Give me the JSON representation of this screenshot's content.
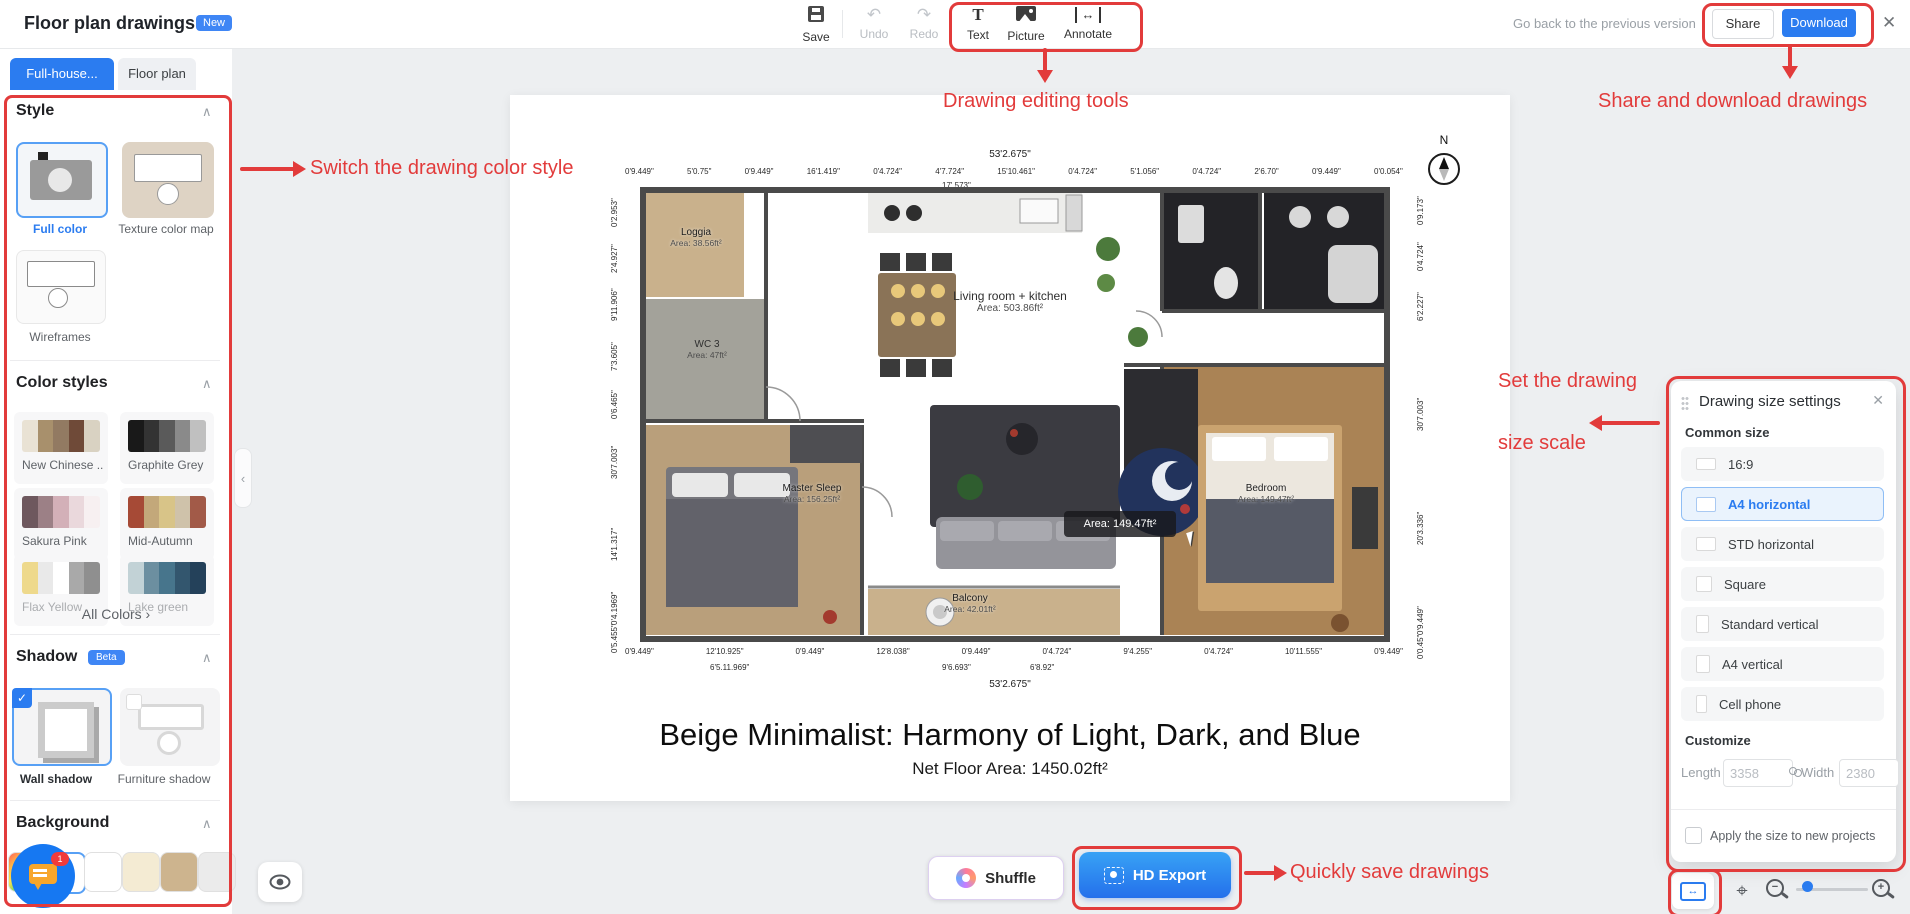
{
  "header": {
    "title": "Floor plan drawings",
    "badge": "New",
    "save": "Save",
    "undo": "Undo",
    "redo": "Redo",
    "text_tool": "Text",
    "picture_tool": "Picture",
    "annotate_tool": "Annotate",
    "go_back": "Go back to the previous version",
    "share": "Share",
    "download": "Download"
  },
  "tabs": [
    {
      "label": "Full-house...",
      "active": true
    },
    {
      "label": "Floor plan",
      "active": false
    }
  ],
  "sidebar": {
    "style": {
      "title": "Style",
      "items": [
        {
          "label": "Full color",
          "selected": true
        },
        {
          "label": "Texture color map",
          "selected": false
        },
        {
          "label": "Wireframes",
          "selected": false
        }
      ]
    },
    "color_styles": {
      "title": "Color styles",
      "all_colors": "All Colors ›",
      "palettes": [
        {
          "name": "New Chinese ...",
          "colors": [
            "#e9e2d4",
            "#a8906c",
            "#927a62",
            "#6f4a38",
            "#d9d2c2"
          ]
        },
        {
          "name": "Graphite Grey",
          "colors": [
            "#191919",
            "#333333",
            "#5a5a5a",
            "#8a8a8a",
            "#c0c0c0"
          ]
        },
        {
          "name": "Sakura Pink",
          "colors": [
            "#6e585e",
            "#9c8086",
            "#d3b0b8",
            "#ead8dc",
            "#f7f0f1"
          ]
        },
        {
          "name": "Mid-Autumn",
          "colors": [
            "#a64a36",
            "#c3a87a",
            "#d8c488",
            "#cfc2aa",
            "#a25a48"
          ]
        },
        {
          "name": "Flax Yellow",
          "colors": [
            "#eed98c",
            "#e9e9e9",
            "#ffffff",
            "#a9a9a9",
            "#8f8f8f"
          ]
        },
        {
          "name": "Lake green",
          "colors": [
            "#c2d2d6",
            "#6c8fa0",
            "#47758c",
            "#33566e",
            "#24415a"
          ]
        }
      ]
    },
    "shadow": {
      "title": "Shadow",
      "beta": "Beta",
      "items": [
        {
          "label": "Wall shadow",
          "selected": true
        },
        {
          "label": "Furniture shadow",
          "selected": false
        }
      ]
    },
    "background": {
      "title": "Background",
      "swatches": [
        "rainbow",
        "#ffffff",
        "#ffffff",
        "#f4ebd3",
        "#cdb48e",
        "#ebebeb"
      ],
      "selected_index": 1
    }
  },
  "chat_badge": "1",
  "canvas": {
    "plan": {
      "compass": "N",
      "dim_top_main": "53'2.675\"",
      "dims_top": [
        "0'9.449\"",
        "5'0.75\"",
        "0'9.449\"",
        "16'1.419\"",
        "0'4.724\"",
        "4'7.724\"",
        "15'10.461\"",
        "0'4.724\"",
        "5'1.056\"",
        "0'4.724\"",
        "2'6.70\"",
        "0'9.449\"",
        "0'0.054\""
      ],
      "dim_top_sub": "17'.573\"",
      "dims_bottom": [
        "0'9.449\"",
        "12'10.925\"",
        "0'9.449\"",
        "12'8.038\"",
        "0'9.449\"",
        "0'4.724\"",
        "9'4.255\"",
        "0'4.724\"",
        "10'11.555\"",
        "0'9.449\""
      ],
      "dims_bottom_sub": [
        "6'5.11.969\"",
        "9'6.693\"",
        "6'8.92\""
      ],
      "dim_bottom_main": "53'2.675\"",
      "dims_left": [
        "0'2.953\"",
        "2'4.927\"",
        "9'11.906\"",
        "7'3.605\"",
        "0'6.465\"",
        "30'7.003\"",
        "14'1.317\"",
        "0'4.1969\"",
        "0'5.455\""
      ],
      "dims_right": [
        "0'9.173\"",
        "0'4.724\"",
        "6'2.227\"",
        "30'7.003\"",
        "20'3.336\"",
        "0'9.449\"",
        "0'0.45\""
      ],
      "rooms": [
        {
          "name": "Loggia",
          "area": "Area: 38.56ft²"
        },
        {
          "name": "WC 3",
          "area": "Area: 47ft²"
        },
        {
          "name": "Living room + kitchen",
          "area": "Area: 503.86ft²"
        },
        {
          "name": "Master Sleep",
          "area": "Area: 156.25ft²"
        },
        {
          "name": "Balcony",
          "area": "Area: 42.01ft²"
        },
        {
          "name": "Bedroom",
          "area": "Area: 149.47ft²"
        }
      ],
      "tooltip_area": "Area: 149.47ft²",
      "title": "Beige Minimalist: Harmony of Light, Dark, and Blue",
      "net_area": "Net Floor Area:  1450.02ft²"
    },
    "shuffle": "Shuffle",
    "hd_export": "HD Export"
  },
  "size_panel": {
    "title": "Drawing size settings",
    "common_size": "Common size",
    "options": [
      "16:9",
      "A4 horizontal",
      "STD horizontal",
      "Square",
      "Standard vertical",
      "A4 vertical",
      "Cell phone"
    ],
    "selected": "A4 horizontal",
    "customize": "Customize",
    "length_label": "Length",
    "length_value": "3358",
    "width_label": "Width",
    "width_value": "2380",
    "apply_label": "Apply the size to new projects"
  },
  "annotations": {
    "color": "#e23b3b",
    "editing_tools": "Drawing editing tools",
    "share_download": "Share and download drawings",
    "switch_style": "Switch the drawing color style",
    "size_scale_line1": "Set the drawing",
    "size_scale_line2": "size scale",
    "quick_save": "Quickly save drawings"
  },
  "glyphs": {
    "undo": "↶",
    "redo": "↷",
    "annotate": "↔",
    "close": "✕",
    "chevron_up": "∧",
    "all_colors_arrow": "›",
    "collapse": "‹",
    "focus": "⌖",
    "minus": "−",
    "plus": "+",
    "check": "✓",
    "fit": "↔"
  }
}
